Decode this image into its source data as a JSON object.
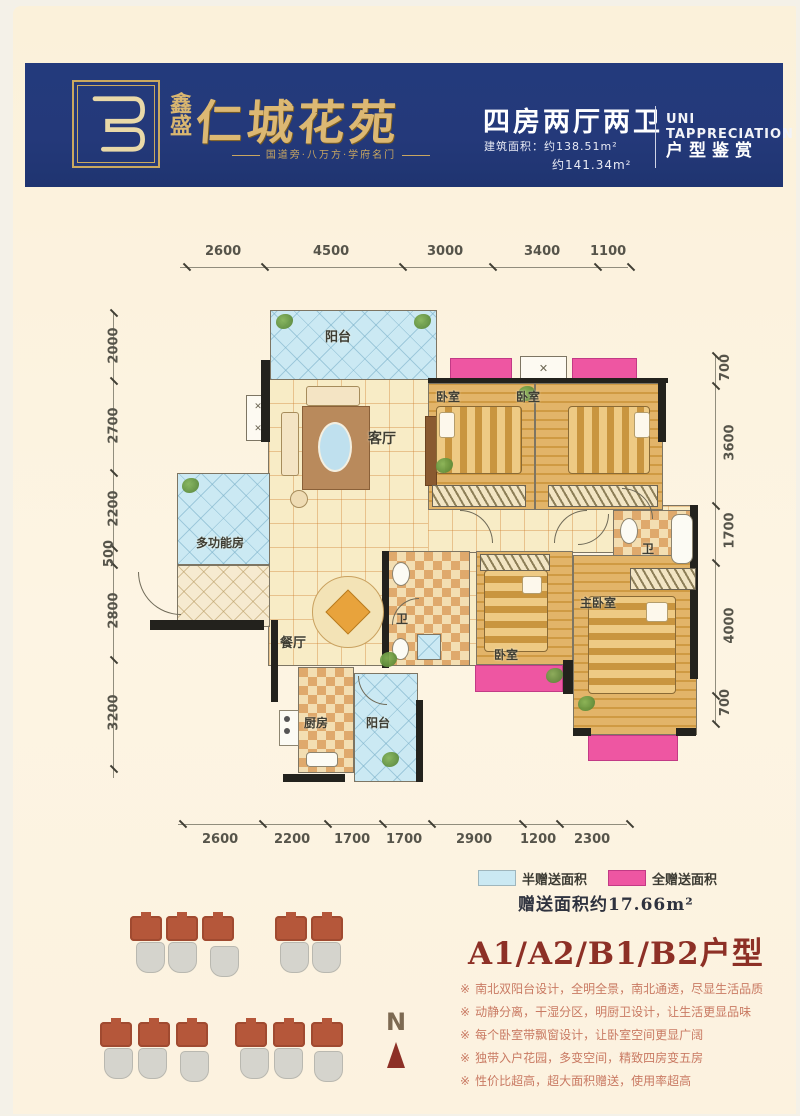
{
  "header": {
    "brand_vertical": "鑫盛",
    "brand_name": "仁城花苑",
    "tagline": "国道旁·八万方·学府名门",
    "unit_type": "四房两厅两卫",
    "area_line1": "建筑面积：约138.51m²",
    "area_line2": "约141.34m²",
    "english_title": "UNI TAPPRECIATION",
    "appreciation": "户型鉴赏"
  },
  "floorplan": {
    "room_labels": [
      "阳台",
      "客厅",
      "卧室",
      "卧室",
      "多功能房",
      "餐厅",
      "卫",
      "卧室",
      "主卧室",
      "卫",
      "厨房",
      "阳台"
    ],
    "dimensions": {
      "top": [
        "2600",
        "4500",
        "3000",
        "3400",
        "1100"
      ],
      "bottom": [
        "2600",
        "2200",
        "1700",
        "1700",
        "2900",
        "1200",
        "2300"
      ],
      "left": [
        "2000",
        "2700",
        "2200",
        "500",
        "2800",
        "3200"
      ],
      "right": [
        "700",
        "3600",
        "1700",
        "4000",
        "700"
      ]
    }
  },
  "legend": {
    "half_label": "半赠送面积",
    "full_label": "全赠送面积",
    "half_color": "#cbe9f3",
    "full_color": "#ee56a2",
    "gift_area": "赠送面积约17.66m²"
  },
  "unit_title": "A1/A2/B1/B2户型",
  "feature_marker": "※",
  "features": [
    "南北双阳台设计，全明全景，南北通透，尽显生活品质",
    "动静分离，干湿分区，明厨卫设计，让生活更显品味",
    "每个卧室带飘窗设计，让卧室空间更显广阔",
    "独带入户花园，多变空间，精致四房变五房",
    "性价比超高，超大面积赠送，使用率超高"
  ],
  "compass": {
    "letter": "N"
  },
  "colors": {
    "header_navy": "#24397a",
    "brand_gold": "#dcb873",
    "page_cream": "#fbf1da",
    "title_red": "#8d3026",
    "feature_salmon": "#c97a63",
    "building_red": "#b5573a",
    "building_grey": "#d5d4cd"
  }
}
